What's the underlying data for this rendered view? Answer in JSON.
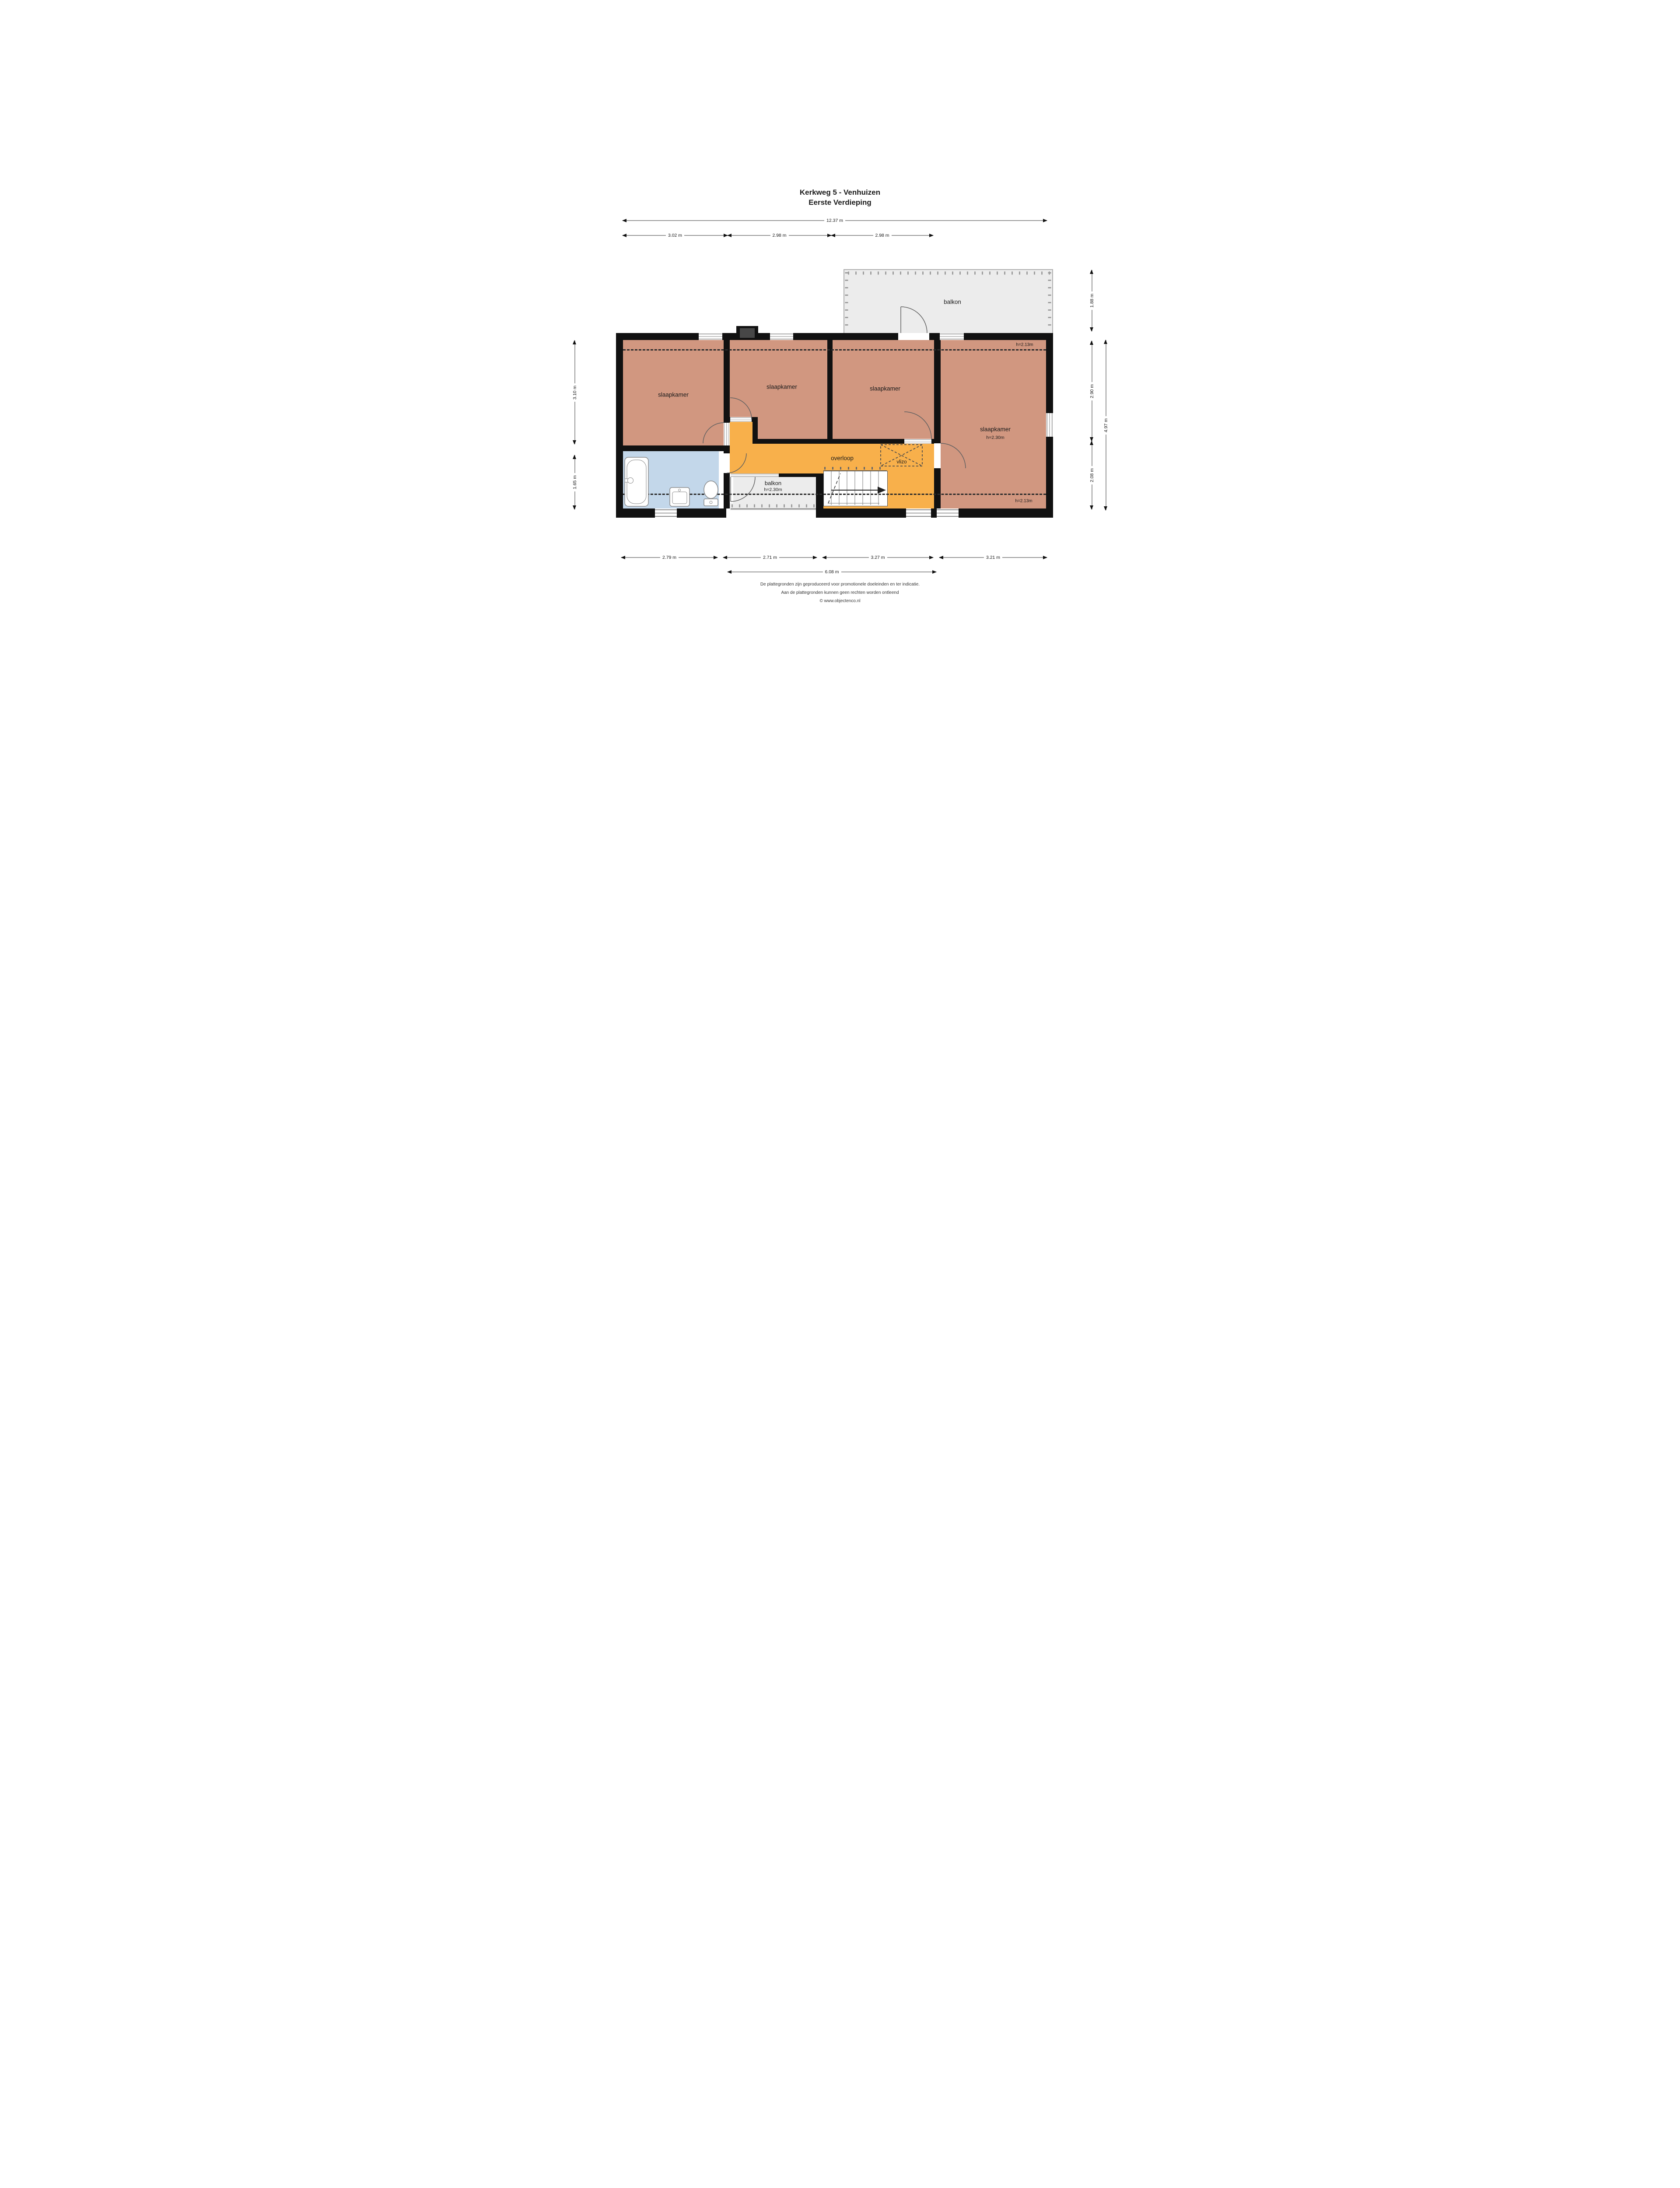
{
  "title": {
    "line1": "Kerkweg 5 - Venhuizen",
    "line2": "Eerste Verdieping"
  },
  "rooms": {
    "bedroom": "slaapkamer",
    "bedroom_height": "h=2.30m",
    "landing": "overloop",
    "attic_hatch": "vlizo",
    "balcony_top": "balkon",
    "balcony_bottom": "balkon",
    "balcony_bottom_height": "h=2.30m",
    "ceiling_height_top": "h=2.13m",
    "ceiling_height_bottom": "h=2.13m"
  },
  "colors": {
    "bedroom_fill": "#d19780",
    "landing_fill": "#f8b04b",
    "bathroom_fill": "#c3d7ea",
    "balcony_fill": "#ececec",
    "wall": "#111111"
  },
  "dims": {
    "top_total": "12.37 m",
    "top_segments": [
      "3.02 m",
      "2.98 m",
      "2.98 m"
    ],
    "bottom_segments": [
      "2.79 m",
      "2.71 m",
      "3.27 m",
      "3.21 m"
    ],
    "bottom_total": "6.08 m",
    "left_segments": [
      "3.10 m",
      "1.65 m"
    ],
    "right_segments": [
      "1.88 m",
      "2.90 m",
      "2.08 m"
    ],
    "right_total": "4.97 m"
  },
  "footer": {
    "line1": "De plattegronden zijn geproduceerd voor promotionele doeleinden en ter indicatie.",
    "line2": "Aan de plattegronden kunnen geen rechten worden ontleend",
    "line3": "© www.objectenco.nl"
  }
}
